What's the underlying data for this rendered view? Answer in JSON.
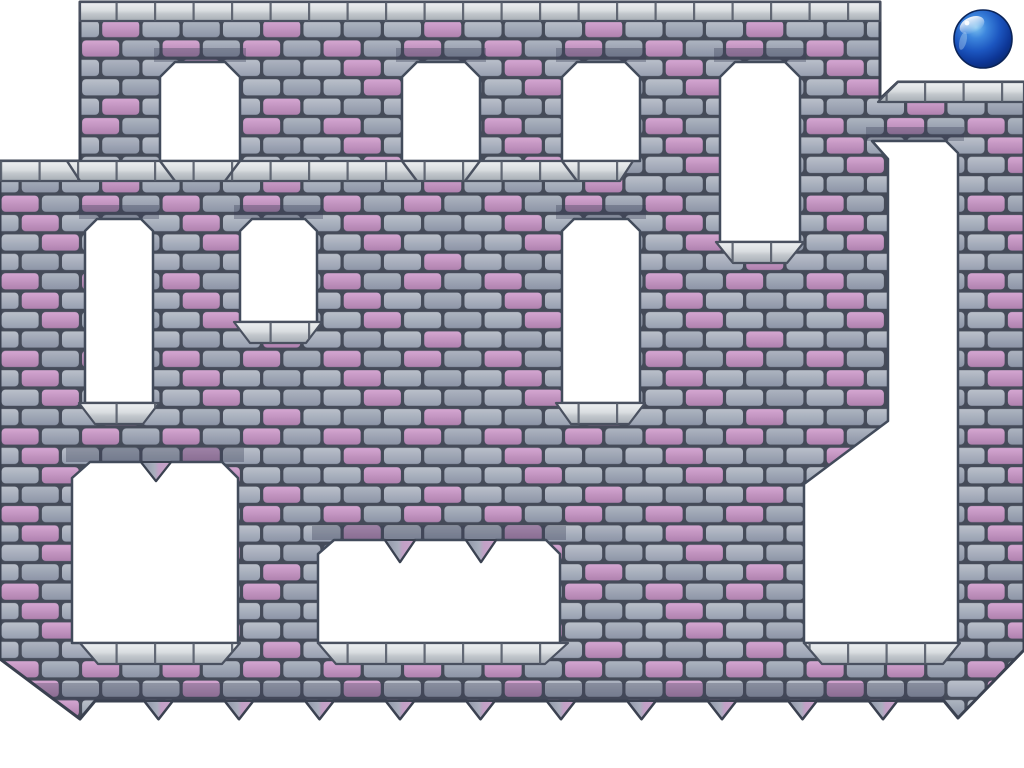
{
  "scene": {
    "width": 1024,
    "height": 768,
    "background": "#ffffff",
    "description": "castle-brick platformer level with white passages, hanging spikes and a blue player ball"
  },
  "colors": {
    "grout": "#454b59",
    "outline": "#3a4150",
    "cutout_stroke": "#424b5b",
    "silver_stroke": "#4a5160",
    "grey_brick_light": [
      "#bac0ca",
      "#98a0b1"
    ],
    "grey_brick_dark": [
      "#adb4c0",
      "#8d95a7"
    ],
    "pink_brick": [
      "#d4a6d1",
      "#b082af"
    ],
    "cap_gradient": [
      "#eef0f2",
      "#d9dde0",
      "#c2c7cc",
      "#a6adb4"
    ],
    "spike_gradient": [
      "#8f97a8",
      "#a9afbe",
      "#c2a0c6",
      "#caa5cb"
    ],
    "shadow_tint": "rgba(58,64,86,0.35)",
    "base_row_tint": "rgba(58,64,86,0.30)",
    "joint": "#555c6a",
    "ball_body": [
      "#7ec3f0",
      "#3d86dd",
      "#1c56c0",
      "#0d3696",
      "#0a2a70"
    ],
    "ball_rim": "#0b2458",
    "white": "#ffffff"
  },
  "pattern": {
    "tile_w": 161,
    "tile_h": 77.6,
    "brick_w": 40.25,
    "brick_h": 19.4,
    "inset": 1.6,
    "radius": 4,
    "pink_cells": [
      [
        0,
        1
      ],
      [
        1,
        3
      ],
      [
        2,
        0
      ],
      [
        2,
        2
      ],
      [
        3,
        1
      ]
    ]
  },
  "wall": {
    "outline": [
      [
        80,
        2
      ],
      [
        880,
        2
      ],
      [
        880,
        99
      ],
      [
        898,
        82
      ],
      [
        1024,
        82
      ],
      [
        1024,
        650
      ],
      [
        958,
        718
      ],
      [
        944,
        701
      ],
      [
        897,
        701
      ],
      [
        883,
        719
      ],
      [
        869,
        701
      ],
      [
        816.5,
        701
      ],
      [
        802.5,
        719
      ],
      [
        788.5,
        701
      ],
      [
        736,
        701
      ],
      [
        722,
        719
      ],
      [
        708,
        701
      ],
      [
        655.5,
        701
      ],
      [
        641.5,
        719
      ],
      [
        627.5,
        701
      ],
      [
        575,
        701
      ],
      [
        561,
        719
      ],
      [
        547,
        701
      ],
      [
        494.5,
        701
      ],
      [
        480.5,
        719
      ],
      [
        466.5,
        701
      ],
      [
        414,
        701
      ],
      [
        400,
        719
      ],
      [
        386,
        701
      ],
      [
        333.5,
        701
      ],
      [
        319.5,
        719
      ],
      [
        305.5,
        701
      ],
      [
        253,
        701
      ],
      [
        239,
        719
      ],
      [
        225,
        701
      ],
      [
        172.5,
        701
      ],
      [
        158.5,
        719
      ],
      [
        144.5,
        701
      ],
      [
        95,
        701
      ],
      [
        80,
        719
      ],
      [
        0,
        659
      ],
      [
        0,
        161
      ],
      [
        80,
        161
      ]
    ],
    "base_row": [
      [
        0,
        683
      ],
      [
        944,
        683
      ],
      [
        944,
        701
      ],
      [
        0,
        701
      ]
    ]
  },
  "openings": [
    {
      "name": "window-1",
      "points": [
        [
          175,
          62
        ],
        [
          225,
          62
        ],
        [
          240,
          77
        ],
        [
          240,
          161
        ],
        [
          160,
          161
        ],
        [
          160,
          77
        ]
      ]
    },
    {
      "name": "window-2",
      "points": [
        [
          417,
          62
        ],
        [
          465,
          62
        ],
        [
          480,
          77
        ],
        [
          480,
          161
        ],
        [
          402,
          161
        ],
        [
          402,
          77
        ]
      ]
    },
    {
      "name": "window-3",
      "points": [
        [
          577,
          62
        ],
        [
          625,
          62
        ],
        [
          640,
          77
        ],
        [
          640,
          161
        ],
        [
          562,
          161
        ],
        [
          562,
          77
        ]
      ]
    },
    {
      "name": "window-4",
      "points": [
        [
          735,
          62
        ],
        [
          785,
          62
        ],
        [
          800,
          77
        ],
        [
          800,
          242
        ],
        [
          720,
          242
        ],
        [
          720,
          77
        ]
      ]
    },
    {
      "name": "window-a",
      "points": [
        [
          97,
          219
        ],
        [
          141,
          219
        ],
        [
          153,
          231
        ],
        [
          153,
          403
        ],
        [
          85,
          403
        ],
        [
          85,
          231
        ]
      ]
    },
    {
      "name": "window-b",
      "points": [
        [
          252,
          219
        ],
        [
          305,
          219
        ],
        [
          317,
          231
        ],
        [
          317,
          322
        ],
        [
          240,
          322
        ],
        [
          240,
          231
        ]
      ]
    },
    {
      "name": "window-c",
      "points": [
        [
          574,
          219
        ],
        [
          628,
          219
        ],
        [
          640,
          231
        ],
        [
          640,
          403
        ],
        [
          562,
          403
        ],
        [
          562,
          231
        ]
      ]
    },
    {
      "name": "doorway-1",
      "points": [
        [
          90,
          462
        ],
        [
          141,
          462
        ],
        [
          156,
          481
        ],
        [
          171,
          462
        ],
        [
          222,
          462
        ],
        [
          238,
          478
        ],
        [
          238,
          643
        ],
        [
          72,
          643
        ],
        [
          72,
          478
        ]
      ]
    },
    {
      "name": "doorway-2",
      "points": [
        [
          334,
          540
        ],
        [
          385,
          540
        ],
        [
          400,
          562
        ],
        [
          415,
          540
        ],
        [
          466,
          540
        ],
        [
          481,
          562
        ],
        [
          496,
          540
        ],
        [
          546,
          540
        ],
        [
          560,
          554
        ],
        [
          560,
          643
        ],
        [
          318,
          643
        ],
        [
          318,
          554
        ]
      ]
    },
    {
      "name": "right-shaft",
      "points": [
        [
          872,
          141
        ],
        [
          946,
          141
        ],
        [
          958,
          153
        ],
        [
          958,
          643
        ],
        [
          804,
          643
        ],
        [
          804,
          484
        ],
        [
          888,
          421
        ],
        [
          888,
          159
        ]
      ]
    }
  ],
  "shadow_strips": [
    {
      "x": 154,
      "y": 48,
      "w": 92,
      "h": 14
    },
    {
      "x": 396,
      "y": 48,
      "w": 90,
      "h": 14
    },
    {
      "x": 556,
      "y": 48,
      "w": 90,
      "h": 14
    },
    {
      "x": 714,
      "y": 48,
      "w": 92,
      "h": 14
    },
    {
      "x": 79,
      "y": 205,
      "w": 80,
      "h": 14
    },
    {
      "x": 234,
      "y": 205,
      "w": 89,
      "h": 14
    },
    {
      "x": 556,
      "y": 205,
      "w": 90,
      "h": 14
    },
    {
      "x": 66,
      "y": 448,
      "w": 178,
      "h": 14
    },
    {
      "x": 312,
      "y": 526,
      "w": 254,
      "h": 14
    },
    {
      "x": 866,
      "y": 127,
      "w": 98,
      "h": 14
    }
  ],
  "caps": [
    {
      "name": "top-cap",
      "points": [
        [
          80,
          2
        ],
        [
          880,
          2
        ],
        [
          880,
          21
        ],
        [
          80,
          21
        ]
      ]
    },
    {
      "name": "main-cap",
      "points": [
        [
          0,
          161
        ],
        [
          633,
          161
        ],
        [
          620,
          181
        ],
        [
          0,
          181
        ]
      ]
    },
    {
      "name": "right-cap",
      "points": [
        [
          898,
          82
        ],
        [
          1024,
          82
        ],
        [
          1024,
          102
        ],
        [
          878,
          102
        ]
      ]
    },
    {
      "name": "sill-window-4",
      "points": [
        [
          716,
          242
        ],
        [
          804,
          242
        ],
        [
          787,
          263
        ],
        [
          733,
          263
        ]
      ]
    },
    {
      "name": "sill-window-a",
      "points": [
        [
          79,
          403
        ],
        [
          159,
          403
        ],
        [
          143,
          424
        ],
        [
          95,
          424
        ]
      ]
    },
    {
      "name": "sill-window-b",
      "points": [
        [
          234,
          322
        ],
        [
          322,
          322
        ],
        [
          306,
          343
        ],
        [
          250,
          343
        ]
      ]
    },
    {
      "name": "sill-window-c",
      "points": [
        [
          556,
          403
        ],
        [
          645,
          403
        ],
        [
          629,
          424
        ],
        [
          571,
          424
        ]
      ]
    },
    {
      "name": "ledge-doorway-1",
      "points": [
        [
          80,
          643
        ],
        [
          240,
          643
        ],
        [
          222,
          664
        ],
        [
          98,
          664
        ]
      ]
    },
    {
      "name": "ledge-doorway-2",
      "points": [
        [
          318,
          643
        ],
        [
          568,
          643
        ],
        [
          545,
          664
        ],
        [
          336,
          664
        ]
      ]
    },
    {
      "name": "ledge-right-shaft",
      "points": [
        [
          804,
          643
        ],
        [
          960,
          643
        ],
        [
          943,
          664
        ],
        [
          822,
          664
        ]
      ]
    }
  ],
  "bevel_lines": [
    [
      160,
      161,
      175,
      181
    ],
    [
      240,
      161,
      225,
      181
    ],
    [
      402,
      161,
      417,
      181
    ],
    [
      480,
      161,
      465,
      181
    ],
    [
      562,
      161,
      577,
      181
    ],
    [
      67,
      161,
      80,
      181
    ]
  ],
  "spikes": {
    "half_w": 14,
    "base_y": 701,
    "tip_y": 719,
    "bottom_centers": [
      158.5,
      239,
      319.5,
      400,
      480.5,
      561,
      641.5,
      722,
      802.5,
      883
    ],
    "hanging": [
      {
        "cx": 156,
        "y": 462,
        "tip": 481,
        "half_w": 15
      },
      {
        "cx": 400,
        "y": 540,
        "tip": 562,
        "half_w": 15
      },
      {
        "cx": 481,
        "y": 540,
        "tip": 562,
        "half_w": 15
      }
    ]
  },
  "ball": {
    "cx": 983,
    "cy": 39,
    "r": 29
  }
}
